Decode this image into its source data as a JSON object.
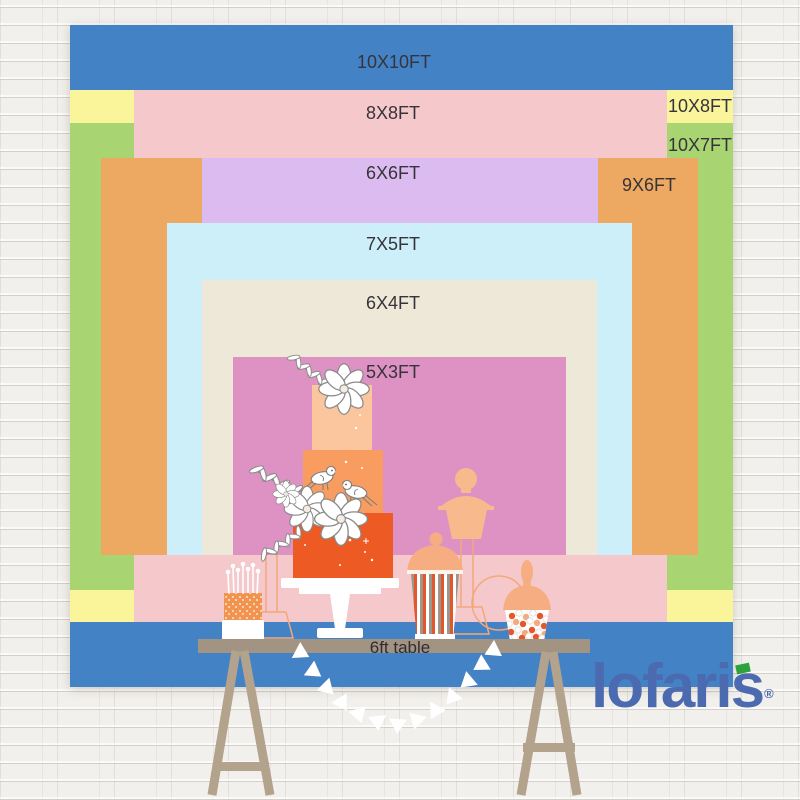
{
  "backdrop_sizes": [
    {
      "id": "10x10",
      "label": "10X10FT",
      "width_ft": 10,
      "height_ft": 10,
      "color": "#4482c6"
    },
    {
      "id": "8x8",
      "label": "8X8FT",
      "width_ft": 8,
      "height_ft": 8,
      "color": "#f5c9cc"
    },
    {
      "id": "10x8",
      "label": "10X8FT",
      "width_ft": 10,
      "height_ft": 8,
      "color": "#faf49b"
    },
    {
      "id": "10x7",
      "label": "10X7FT",
      "width_ft": 10,
      "height_ft": 7,
      "color": "#a8d471"
    },
    {
      "id": "6x6",
      "label": "6X6FT",
      "width_ft": 6,
      "height_ft": 6,
      "color": "#dcbcf0"
    },
    {
      "id": "9x6",
      "label": "9X6FT",
      "width_ft": 9,
      "height_ft": 6,
      "color": "#eda961"
    },
    {
      "id": "7x5",
      "label": "7X5FT",
      "width_ft": 7,
      "height_ft": 5,
      "color": "#cdeff9"
    },
    {
      "id": "6x4",
      "label": "6X4FT",
      "width_ft": 6,
      "height_ft": 4,
      "color": "#eee8d9"
    },
    {
      "id": "5x3",
      "label": "5X3FT",
      "width_ft": 5,
      "height_ft": 3,
      "color": "#de92c3"
    }
  ],
  "table": {
    "label": "6ft table"
  },
  "logo": {
    "text": "lofaris",
    "registered": "®",
    "color": "#4c6ab0",
    "accent_color": "#2da13c"
  },
  "palette": {
    "wall": "#f2f0ec",
    "label_text": "#36343a",
    "tabletop": "#a29382",
    "table_legs": "#b3a28c",
    "cake_top_tier": "#fbc59d",
    "cake_middle_tier": "#f89c60",
    "cake_bottom_tier": "#ee5a24",
    "jar_silhouette": "#f8b98c",
    "stripe_orange": "#e4572c",
    "stripe_grey": "#9d968a",
    "candy_peach": "#f4a97e",
    "bunting": "#ffffff"
  }
}
